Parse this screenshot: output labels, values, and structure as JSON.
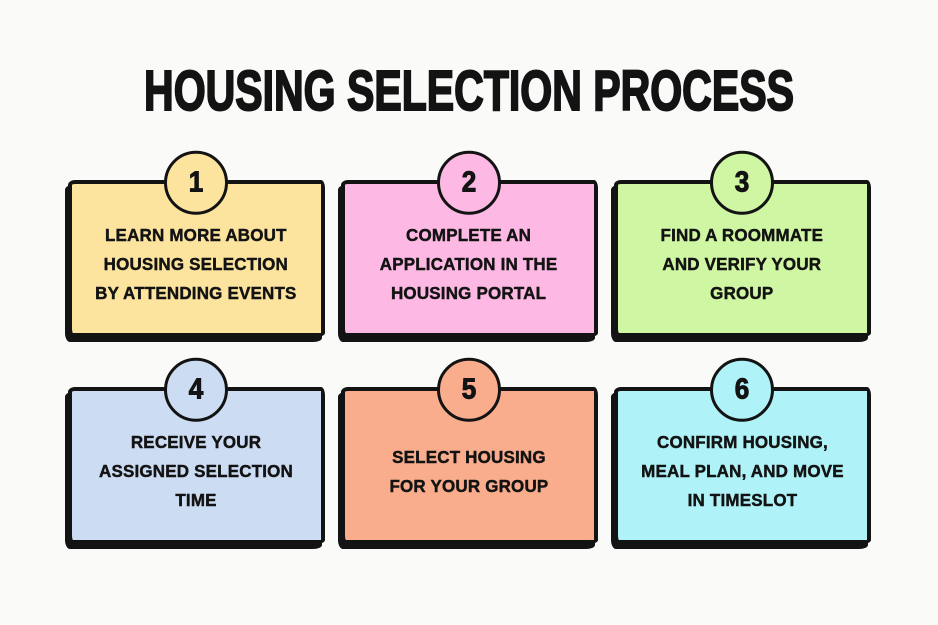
{
  "title": "HOUSING SELECTION PROCESS",
  "background_color": "#FAFAF8",
  "ink_color": "#131313",
  "steps": [
    {
      "number": "1",
      "label": "LEARN MORE ABOUT\nHOUSING SELECTION\nBY ATTENDING EVENTS",
      "color": "#FCE49E"
    },
    {
      "number": "2",
      "label": "COMPLETE AN\nAPPLICATION IN THE\nHOUSING PORTAL",
      "color": "#FDB9E3"
    },
    {
      "number": "3",
      "label": "FIND A ROOMMATE\nAND VERIFY YOUR\nGROUP",
      "color": "#CFF6A2"
    },
    {
      "number": "4",
      "label": "RECEIVE YOUR\nASSIGNED SELECTION\nTIME",
      "color": "#CCDCF2"
    },
    {
      "number": "5",
      "label": "SELECT HOUSING\nFOR YOUR GROUP",
      "color": "#F9AD8D"
    },
    {
      "number": "6",
      "label": "CONFIRM HOUSING,\nMEAL PLAN, AND MOVE\nIN TIMESLOT",
      "color": "#AFF2F7"
    }
  ]
}
